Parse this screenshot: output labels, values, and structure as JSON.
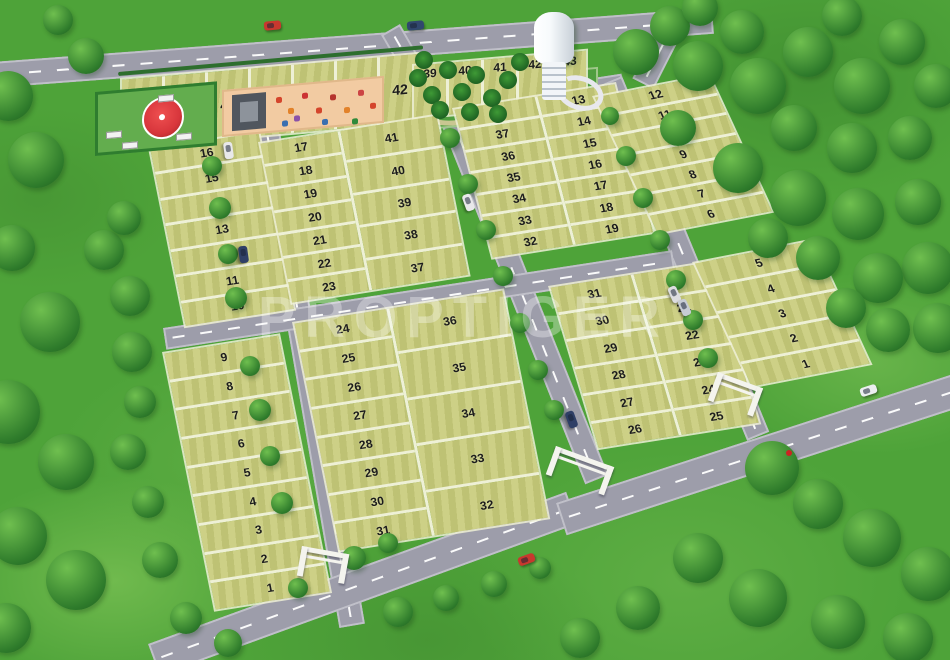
{
  "watermark": "PROPTIGER",
  "colors": {
    "grass": "#4ea339",
    "plot": "#c9cc7c",
    "plot_edge": "#eef0d6",
    "road": "#9d9daa",
    "number": "#1c1c1c",
    "playground": "#f2cba2",
    "park": "#4f9e3f",
    "gazebo_roof": "#d8363c",
    "gate": "#f4f4ee",
    "tower": "#f7fafc",
    "watermark_color": "rgba(255,255,255,0.32)"
  },
  "site": {
    "blocks": [
      {
        "id": "north-row",
        "type": "cols",
        "geom": {
          "left": 120,
          "top": 78,
          "width": 302,
          "height": 72,
          "transform": "skewY(-5deg)"
        },
        "columns": [
          {
            "width": "100%",
            "plots": [
              "48",
              "47",
              "46",
              "45",
              "44",
              "43",
              "42"
            ]
          }
        ]
      },
      {
        "id": "park-row",
        "type": "cols",
        "numTop": true,
        "geom": {
          "left": 412,
          "top": 64,
          "width": 176,
          "height": 56,
          "transform": "skewY(-5deg)"
        },
        "columns": [
          {
            "width": "100%",
            "plots": [
              "39",
              "40",
              "41",
              "42",
              "43"
            ]
          }
        ]
      },
      {
        "id": "west-upper",
        "type": "rows",
        "geom": {
          "left": 148,
          "top": 148,
          "width": 112,
          "height": 186,
          "transform": "skewY(-9deg) skewX(11deg)"
        },
        "columns": [
          {
            "width": "100%",
            "plots": [
              "16",
              "15",
              "14",
              "13",
              "12",
              "11",
              "10"
            ]
          }
        ]
      },
      {
        "id": "west-lower",
        "type": "rows",
        "geom": {
          "left": 162,
          "top": 352,
          "width": 118,
          "height": 268,
          "transform": "skewY(-9deg) skewX(11deg)"
        },
        "columns": [
          {
            "width": "100%",
            "plots": [
              "9",
              "8",
              "7",
              "6",
              "5",
              "4",
              "3",
              "2",
              "1"
            ]
          }
        ]
      },
      {
        "id": "central-upper",
        "type": "rows",
        "geom": {
          "left": 258,
          "top": 142,
          "width": 180,
          "height": 168,
          "transform": "skewY(-9deg) skewX(11deg)"
        },
        "columns": [
          {
            "width": "44%",
            "plots": [
              "17",
              "18",
              "19",
              "20",
              "21",
              "22",
              "23"
            ]
          },
          {
            "width": "56%",
            "plots": [
              "41",
              "40",
              "39",
              "38",
              "37"
            ]
          }
        ]
      },
      {
        "id": "central-lower",
        "type": "rows",
        "geom": {
          "left": 292,
          "top": 322,
          "width": 212,
          "height": 238,
          "transform": "skewY(-9deg) skewX(11deg)"
        },
        "columns": [
          {
            "width": "44%",
            "plots": [
              "24",
              "25",
              "26",
              "27",
              "28",
              "29",
              "30",
              "31"
            ]
          },
          {
            "width": "56%",
            "plots": [
              "36",
              "35",
              "34",
              "33",
              "32"
            ]
          }
        ]
      },
      {
        "id": "east-central-upper",
        "type": "rows",
        "geom": {
          "left": 452,
          "top": 108,
          "width": 164,
          "height": 158,
          "transform": "skewY(-9deg) skewX(14deg)"
        },
        "columns": [
          {
            "width": "50%",
            "plots": [
              "38",
              "37",
              "36",
              "35",
              "34",
              "33",
              "32"
            ]
          },
          {
            "width": "50%",
            "plots": [
              "13",
              "14",
              "15",
              "16",
              "17",
              "18",
              "19"
            ]
          }
        ]
      },
      {
        "id": "east-central-lower",
        "type": "rows",
        "geom": {
          "left": 548,
          "top": 286,
          "width": 164,
          "height": 172,
          "transform": "skewY(-9deg) skewX(16deg)"
        },
        "columns": [
          {
            "width": "50%",
            "plots": [
              "31",
              "30",
              "29",
              "28",
              "27",
              "26"
            ]
          },
          {
            "width": "50%",
            "plots": [
              "20",
              "21",
              "22",
              "23",
              "24",
              "25"
            ]
          }
        ]
      },
      {
        "id": "east-upper",
        "type": "rows",
        "geom": {
          "left": 592,
          "top": 96,
          "width": 118,
          "height": 152,
          "transform": "skewY(-11deg) skewX(23deg)"
        },
        "columns": [
          {
            "width": "100%",
            "plots": [
              "12",
              "11",
              "10",
              "9",
              "8",
              "7",
              "6"
            ]
          }
        ]
      },
      {
        "id": "east-lower",
        "type": "rows",
        "geom": {
          "left": 692,
          "top": 262,
          "width": 122,
          "height": 138,
          "transform": "skewY(-11deg) skewX(23deg)"
        },
        "columns": [
          {
            "width": "100%",
            "plots": [
              "5",
              "4",
              "3",
              "2",
              "1"
            ]
          }
        ]
      }
    ],
    "roads": [
      {
        "id": "north-road",
        "x": -8,
        "y": 62,
        "len": 722,
        "w": 26,
        "a": -4.3
      },
      {
        "id": "park-bend",
        "x": 690,
        "y": 18,
        "len": 80,
        "w": 24,
        "a": 117
      },
      {
        "id": "west-street",
        "x": 279,
        "y": 126,
        "len": 505,
        "w": 26,
        "a": 80.2
      },
      {
        "id": "park-connector",
        "x": 400,
        "y": 24,
        "len": 100,
        "w": 22,
        "a": 60
      },
      {
        "id": "park-street",
        "x": 412,
        "y": 106,
        "len": 212,
        "w": 20,
        "a": -8.8
      },
      {
        "id": "central-street",
        "x": 458,
        "y": 99,
        "len": 405,
        "w": 25,
        "a": 68.2
      },
      {
        "id": "east-street",
        "x": 622,
        "y": 76,
        "len": 385,
        "w": 24,
        "a": 67.5
      },
      {
        "id": "cross-street",
        "x": 163,
        "y": 328,
        "len": 515,
        "w": 22,
        "a": -8.7
      },
      {
        "id": "south-road-west",
        "x": 148,
        "y": 644,
        "len": 445,
        "w": 34,
        "a": -20
      },
      {
        "id": "south-road-east",
        "x": 556,
        "y": 503,
        "len": 420,
        "w": 34,
        "a": -18
      }
    ],
    "gates": [
      {
        "id": "west-entrance-gate",
        "x": 302,
        "y": 546,
        "w": 48,
        "a": 10
      },
      {
        "id": "central-entrance-gate",
        "x": 556,
        "y": 446,
        "w": 62,
        "a": 20
      },
      {
        "id": "east-entrance-gate",
        "x": 718,
        "y": 372,
        "w": 48,
        "a": 20
      }
    ],
    "vehicles": [
      {
        "x": 264,
        "y": 21,
        "a": -5,
        "c": "#c8382e"
      },
      {
        "x": 407,
        "y": 21,
        "a": -5,
        "c": "#31476e"
      },
      {
        "x": 220,
        "y": 146,
        "a": 82,
        "c": "#e8e8ea"
      },
      {
        "x": 235,
        "y": 250,
        "a": 82,
        "c": "#2f3f66"
      },
      {
        "x": 460,
        "y": 198,
        "a": 70,
        "c": "#e8e8ea"
      },
      {
        "x": 666,
        "y": 290,
        "a": 66,
        "c": "#dddde0"
      },
      {
        "x": 676,
        "y": 303,
        "a": 66,
        "c": "#c7ccd4"
      },
      {
        "x": 563,
        "y": 415,
        "a": 70,
        "c": "#2f3f66"
      },
      {
        "x": 518,
        "y": 555,
        "a": -20,
        "c": "#c8382e"
      },
      {
        "x": 860,
        "y": 386,
        "a": -18,
        "c": "#eceef0"
      }
    ],
    "trees": [
      [
        8,
        96,
        50
      ],
      [
        36,
        160,
        56
      ],
      [
        12,
        248,
        46
      ],
      [
        50,
        322,
        60
      ],
      [
        8,
        412,
        64
      ],
      [
        66,
        462,
        56
      ],
      [
        18,
        536,
        58
      ],
      [
        76,
        580,
        60
      ],
      [
        6,
        628,
        50
      ],
      [
        104,
        250,
        40
      ],
      [
        124,
        218,
        34
      ],
      [
        130,
        296,
        40
      ],
      [
        86,
        56,
        36
      ],
      [
        58,
        20,
        30
      ],
      [
        636,
        52,
        46
      ],
      [
        670,
        26,
        40
      ],
      [
        698,
        66,
        50
      ],
      [
        742,
        32,
        44
      ],
      [
        758,
        86,
        56
      ],
      [
        808,
        52,
        50
      ],
      [
        842,
        16,
        40
      ],
      [
        862,
        86,
        56
      ],
      [
        902,
        42,
        46
      ],
      [
        936,
        86,
        44
      ],
      [
        700,
        8,
        36
      ],
      [
        794,
        128,
        46
      ],
      [
        852,
        148,
        50
      ],
      [
        910,
        138,
        44
      ],
      [
        678,
        128,
        36
      ],
      [
        738,
        168,
        50
      ],
      [
        798,
        198,
        56
      ],
      [
        858,
        214,
        52
      ],
      [
        918,
        202,
        46
      ],
      [
        928,
        268,
        52
      ],
      [
        878,
        278,
        50
      ],
      [
        818,
        258,
        44
      ],
      [
        768,
        238,
        40
      ],
      [
        938,
        328,
        50
      ],
      [
        888,
        330,
        44
      ],
      [
        846,
        308,
        40
      ],
      [
        772,
        468,
        54
      ],
      [
        818,
        504,
        50
      ],
      [
        872,
        538,
        58
      ],
      [
        928,
        574,
        54
      ],
      [
        698,
        558,
        50
      ],
      [
        758,
        598,
        58
      ],
      [
        838,
        622,
        54
      ],
      [
        908,
        638,
        50
      ],
      [
        638,
        608,
        44
      ],
      [
        580,
        638,
        40
      ],
      [
        398,
        612,
        30
      ],
      [
        446,
        598,
        26
      ],
      [
        494,
        584,
        26
      ],
      [
        540,
        568,
        22
      ],
      [
        212,
        166,
        20
      ],
      [
        220,
        208,
        22
      ],
      [
        228,
        254,
        20
      ],
      [
        236,
        298,
        22
      ],
      [
        250,
        366,
        20
      ],
      [
        260,
        410,
        22
      ],
      [
        270,
        456,
        20
      ],
      [
        282,
        503,
        22
      ],
      [
        450,
        138,
        20
      ],
      [
        468,
        184,
        20
      ],
      [
        486,
        230,
        20
      ],
      [
        503,
        276,
        20
      ],
      [
        520,
        323,
        20
      ],
      [
        538,
        370,
        20
      ],
      [
        554,
        410,
        20
      ],
      [
        610,
        116,
        18
      ],
      [
        626,
        156,
        20
      ],
      [
        643,
        198,
        20
      ],
      [
        660,
        240,
        20
      ],
      [
        676,
        280,
        20
      ],
      [
        693,
        320,
        20
      ],
      [
        708,
        358,
        20
      ],
      [
        354,
        558,
        24
      ],
      [
        388,
        543,
        20
      ],
      [
        298,
        588,
        20
      ],
      [
        160,
        560,
        36
      ],
      [
        186,
        618,
        32
      ],
      [
        228,
        643,
        28
      ],
      [
        132,
        352,
        40
      ],
      [
        140,
        402,
        32
      ],
      [
        128,
        452,
        36
      ],
      [
        148,
        502,
        32
      ]
    ],
    "palms": [
      [
        418,
        78
      ],
      [
        432,
        95
      ],
      [
        448,
        70
      ],
      [
        462,
        92
      ],
      [
        476,
        75
      ],
      [
        492,
        98
      ],
      [
        508,
        80
      ],
      [
        520,
        62
      ],
      [
        440,
        110
      ],
      [
        470,
        112
      ],
      [
        498,
        114
      ],
      [
        424,
        60
      ]
    ],
    "playground_equipment": [
      [
        52,
        10,
        "#d4452c"
      ],
      [
        64,
        22,
        "#e2822a"
      ],
      [
        78,
        8,
        "#cc3333"
      ],
      [
        92,
        24,
        "#d4452c"
      ],
      [
        106,
        12,
        "#b5342e"
      ],
      [
        120,
        26,
        "#e2822a"
      ],
      [
        134,
        10,
        "#cc4444"
      ],
      [
        146,
        24,
        "#d4452c"
      ],
      [
        58,
        34,
        "#3a6fb0"
      ],
      [
        98,
        36,
        "#3a6fb0"
      ],
      [
        128,
        38,
        "#2f8a3a"
      ],
      [
        70,
        30,
        "#8a52a8"
      ]
    ]
  }
}
